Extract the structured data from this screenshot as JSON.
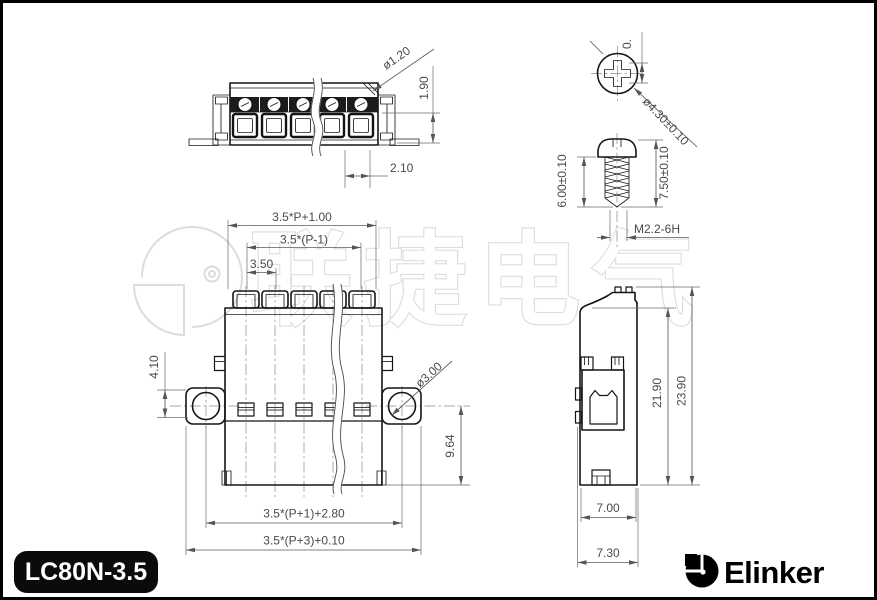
{
  "title_block": {
    "model": "LC80N-3.5",
    "brand": "Elinker"
  },
  "watermark": {
    "text": "联捷电气"
  },
  "top_view": {
    "dim_hole": "ø1.20",
    "dim_height": "1.90",
    "dim_pitch": "2.10"
  },
  "screw_top_view": {
    "dim_clipped": "0.",
    "dim_head_dia": "ø4.30±0.10"
  },
  "screw_side_view": {
    "dim_thread_length": "6.00±0.10",
    "dim_total_length": "7.50±0.10",
    "thread_spec": "M2.2-6H"
  },
  "front_view": {
    "dim_width_top": "3.5*P+1.00",
    "dim_screw_span": "3.5*(P-1)",
    "dim_pitch": "3.50",
    "dim_flange_height": "4.10",
    "dim_mount_hole": "ø3.00",
    "dim_body_height": "9.64",
    "dim_flange_span": "3.5*(P+1)+2.80",
    "dim_overall_width": "3.5*(P+3)+0.10"
  },
  "side_view": {
    "dim_inner_height": "21.90",
    "dim_total_height": "23.90",
    "dim_body_width": "7.00",
    "dim_total_width": "7.30"
  },
  "colors": {
    "line": "#151515",
    "dimension": "#4a4a4a",
    "watermark": "#dcdcdc",
    "badge_bg": "#0b0b0b",
    "badge_fg": "#ffffff"
  }
}
